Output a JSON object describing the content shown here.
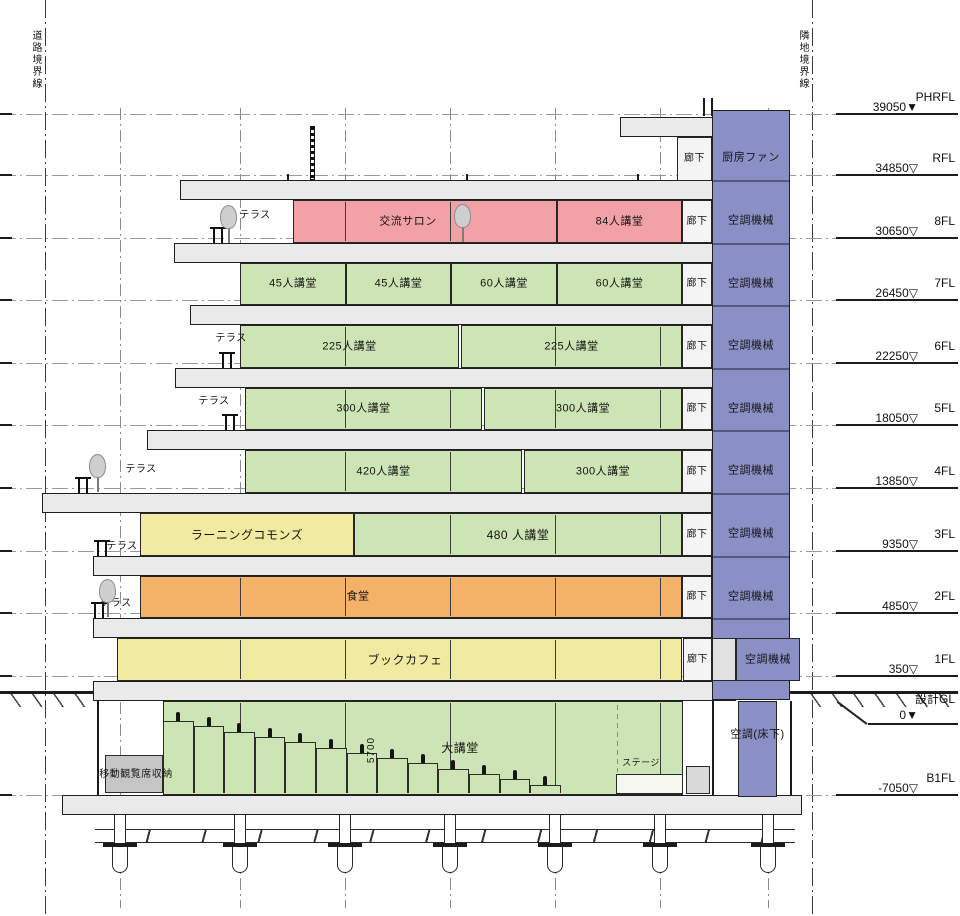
{
  "colors": {
    "pink": "#F2A1A6",
    "green": "#CDE4B4",
    "yellow": "#F0EBA0",
    "orange": "#F4B168",
    "blue": "#8A8FC5",
    "corridor": "#F4F4F4",
    "slab": "#EAEAEA",
    "storage": "#C6C6C6",
    "grey": "#E2E2E2",
    "white": "#FBFBFB"
  },
  "boundaries": {
    "left": {
      "label": "道路境界線",
      "x": 45
    },
    "right": {
      "label": "隣地境界線",
      "x": 812
    }
  },
  "grid_x": [
    120,
    240,
    345,
    450,
    555,
    660,
    768
  ],
  "levels": [
    {
      "label": "PHRFL",
      "elev": "39050",
      "tri": "▼",
      "y": 114
    },
    {
      "label": "RFL",
      "elev": "34850",
      "tri": "▽",
      "y": 175
    },
    {
      "label": "8FL",
      "elev": "30650",
      "tri": "▽",
      "y": 238
    },
    {
      "label": "7FL",
      "elev": "26450",
      "tri": "▽",
      "y": 300
    },
    {
      "label": "6FL",
      "elev": "22250",
      "tri": "▽",
      "y": 363
    },
    {
      "label": "5FL",
      "elev": "18050",
      "tri": "▽",
      "y": 425
    },
    {
      "label": "4FL",
      "elev": "13850",
      "tri": "▽",
      "y": 488
    },
    {
      "label": "3FL",
      "elev": "9350",
      "tri": "▽",
      "y": 551
    },
    {
      "label": "2FL",
      "elev": "4850",
      "tri": "▽",
      "y": 613
    },
    {
      "label": "1FL",
      "elev": "350",
      "tri": "▽",
      "y": 676
    },
    {
      "label": "B1FL",
      "elev": "-7050",
      "tri": "▽",
      "y": 795
    }
  ],
  "gl": {
    "label": "設計GL",
    "elev": "0",
    "tri": "▼",
    "line_y": 691,
    "label_y": 697,
    "elev_y": 712,
    "underline_y": 723
  },
  "slabs": [
    {
      "x": 620,
      "y": 117,
      "w": 95,
      "h": 20
    },
    {
      "x": 180,
      "y": 180,
      "w": 534,
      "h": 20
    },
    {
      "x": 174,
      "y": 243,
      "w": 540,
      "h": 20
    },
    {
      "x": 190,
      "y": 305,
      "w": 524,
      "h": 20
    },
    {
      "x": 175,
      "y": 368,
      "w": 539,
      "h": 20
    },
    {
      "x": 147,
      "y": 430,
      "w": 567,
      "h": 20
    },
    {
      "x": 42,
      "y": 493,
      "w": 670,
      "h": 20
    },
    {
      "x": 93,
      "y": 556,
      "w": 619,
      "h": 20
    },
    {
      "x": 93,
      "y": 618,
      "w": 619,
      "h": 20
    },
    {
      "x": 93,
      "y": 681,
      "w": 643,
      "h": 20
    },
    {
      "x": 62,
      "y": 795,
      "w": 740,
      "h": 20
    }
  ],
  "shaft": {
    "x": 712,
    "w": 78,
    "y": 110,
    "h": 590,
    "divider_ys": [
      180,
      243,
      305,
      368,
      430,
      493,
      556,
      618
    ],
    "labels": [
      {
        "text": "厨房ファン",
        "cy": 158
      },
      {
        "text": "空調機械",
        "cy": 221
      },
      {
        "text": "空調機械",
        "cy": 284
      },
      {
        "text": "空調機械",
        "cy": 346
      },
      {
        "text": "空調機械",
        "cy": 409
      },
      {
        "text": "空調機械",
        "cy": 471
      },
      {
        "text": "空調機械",
        "cy": 534
      },
      {
        "text": "空調機械",
        "cy": 597
      }
    ]
  },
  "rooms": [
    {
      "label": "廊下",
      "x": 677,
      "y": 137,
      "w": 35,
      "h": 44,
      "c": "corridor",
      "fs": 10
    },
    {
      "label": "交流サロン",
      "x": 293,
      "y": 200,
      "w": 264,
      "h": 43,
      "c": "pink",
      "m": true,
      "lx": 408
    },
    {
      "label": "84人講堂",
      "x": 557,
      "y": 200,
      "w": 125,
      "h": 43,
      "c": "pink"
    },
    {
      "label": "廊下",
      "x": 682,
      "y": 200,
      "w": 30,
      "h": 43,
      "c": "corridor",
      "fs": 10
    },
    {
      "label": "45人講堂",
      "x": 240,
      "y": 263,
      "w": 106,
      "h": 42,
      "c": "green"
    },
    {
      "label": "45人講堂",
      "x": 346,
      "y": 263,
      "w": 105,
      "h": 42,
      "c": "green"
    },
    {
      "label": "60人講堂",
      "x": 451,
      "y": 263,
      "w": 106,
      "h": 42,
      "c": "green"
    },
    {
      "label": "60人講堂",
      "x": 557,
      "y": 263,
      "w": 125,
      "h": 42,
      "c": "green"
    },
    {
      "label": "廊下",
      "x": 682,
      "y": 263,
      "w": 30,
      "h": 42,
      "c": "corridor",
      "fs": 10
    },
    {
      "label": "225人講堂",
      "x": 240,
      "y": 325,
      "w": 219,
      "h": 43,
      "c": "green",
      "m": true
    },
    {
      "label": "225人講堂",
      "x": 461,
      "y": 325,
      "w": 221,
      "h": 43,
      "c": "green",
      "m": true
    },
    {
      "label": "廊下",
      "x": 682,
      "y": 325,
      "w": 30,
      "h": 43,
      "c": "corridor",
      "fs": 10
    },
    {
      "label": "300人講堂",
      "x": 245,
      "y": 388,
      "w": 237,
      "h": 42,
      "c": "green",
      "m": true
    },
    {
      "label": "300人講堂",
      "x": 484,
      "y": 388,
      "w": 198,
      "h": 42,
      "c": "green",
      "m": true
    },
    {
      "label": "廊下",
      "x": 682,
      "y": 388,
      "w": 30,
      "h": 42,
      "c": "corridor",
      "fs": 10
    },
    {
      "label": "420人講堂",
      "x": 245,
      "y": 450,
      "w": 277,
      "h": 43,
      "c": "green",
      "m": true
    },
    {
      "label": "300人講堂",
      "x": 524,
      "y": 450,
      "w": 158,
      "h": 43,
      "c": "green"
    },
    {
      "label": "廊下",
      "x": 682,
      "y": 450,
      "w": 30,
      "h": 43,
      "c": "corridor",
      "fs": 10
    },
    {
      "label": "ラーニングコモンズ",
      "x": 140,
      "y": 513,
      "w": 214,
      "h": 43,
      "c": "yellow",
      "fs": 12
    },
    {
      "label": "480 人講堂",
      "x": 354,
      "y": 513,
      "w": 328,
      "h": 43,
      "c": "green",
      "m": true,
      "fs": 12
    },
    {
      "label": "廊下",
      "x": 682,
      "y": 513,
      "w": 30,
      "h": 43,
      "c": "corridor",
      "fs": 10
    },
    {
      "label": "食堂",
      "x": 140,
      "y": 576,
      "w": 542,
      "h": 42,
      "c": "orange",
      "m": true,
      "lx": 358
    },
    {
      "label": "廊下",
      "x": 682,
      "y": 576,
      "w": 30,
      "h": 42,
      "c": "corridor",
      "fs": 10
    },
    {
      "label": "ブックカフェ",
      "x": 117,
      "y": 638,
      "w": 565,
      "h": 43,
      "c": "yellow",
      "m": true,
      "lx": 405,
      "fs": 12
    },
    {
      "label": "廊下",
      "x": 683,
      "y": 638,
      "w": 29,
      "h": 43,
      "c": "corridor",
      "fs": 10
    },
    {
      "label": "",
      "x": 712,
      "y": 638,
      "w": 24,
      "h": 43,
      "c": "grey"
    },
    {
      "label": "空調機械",
      "x": 736,
      "y": 638,
      "w": 64,
      "h": 43,
      "c": "blue"
    },
    {
      "label": "大講堂",
      "x": 163,
      "y": 701,
      "w": 520,
      "h": 94,
      "c": "green",
      "m": true,
      "lx": 460,
      "fs": 12
    },
    {
      "label": "空調(床下)",
      "x": 738,
      "y": 701,
      "w": 39,
      "h": 96,
      "c": "blue",
      "ly": 735
    }
  ],
  "terraces": [
    {
      "label": "テラス",
      "cx": 255,
      "cy": 216,
      "posts": [
        213,
        221
      ],
      "bottom": 243
    },
    {
      "label": "テラス",
      "cx": 231,
      "cy": 339,
      "posts": [
        222,
        230
      ],
      "bottom": 368
    },
    {
      "label": "テラス",
      "cx": 214,
      "cy": 402,
      "posts": [
        225,
        233
      ],
      "bottom": 430
    },
    {
      "label": "テラス",
      "cx": 141,
      "cy": 470,
      "posts": [
        78,
        86
      ],
      "bottom": 493
    },
    {
      "label": "テラス",
      "cx": 122,
      "cy": 547,
      "posts": [
        97,
        105
      ],
      "bottom": 556
    },
    {
      "label": "テラス",
      "cx": 116,
      "cy": 604,
      "posts": [
        94,
        102
      ],
      "bottom": 618
    }
  ],
  "trees": [
    {
      "x": 228,
      "b": 243
    },
    {
      "x": 462,
      "b": 242
    },
    {
      "x": 97,
      "b": 492
    },
    {
      "x": 107,
      "b": 617
    }
  ],
  "b1": {
    "storage": {
      "label": "移動観覧席収納",
      "x": 105,
      "y": 755,
      "w": 58,
      "h": 38,
      "label_cx": 136,
      "label_cy": 775
    },
    "stage": {
      "label": "ステージ",
      "x": 616,
      "y": 774,
      "w": 67,
      "h": 20,
      "label_cx": 641,
      "label_cy": 763
    },
    "dim": {
      "text": "5700",
      "cx": 372,
      "cy": 750
    },
    "steps": {
      "x0": 163,
      "count": 13,
      "step_w": 30.6,
      "floor_y": 793,
      "h0": 72,
      "dh": 5.3
    },
    "dash_x": 617,
    "walls_x": [
      97,
      712,
      790
    ],
    "grey_box": {
      "x": 686,
      "y": 766,
      "w": 24,
      "h": 28
    }
  },
  "ground": {
    "left": {
      "x": 0,
      "w": 97
    },
    "right": {
      "x": 800,
      "w": 158
    },
    "thick_y": 691,
    "leader": {
      "x": 838,
      "y": 701,
      "len": 37,
      "deg": 37
    }
  },
  "foundation": {
    "beam": {
      "x": 95,
      "y": 829,
      "w": 700,
      "h": 14
    },
    "stub": {
      "y": 815,
      "h": 28,
      "w": 12
    },
    "cap": {
      "y": 843,
      "h": 4,
      "w": 34
    },
    "pile": {
      "y": 847,
      "h": 26,
      "w": 16
    }
  },
  "roof": {
    "antenna": {
      "x": 310,
      "y": 126,
      "h": 54
    },
    "ticks": [
      287,
      466,
      637
    ],
    "right_posts": [
      703,
      711
    ]
  }
}
